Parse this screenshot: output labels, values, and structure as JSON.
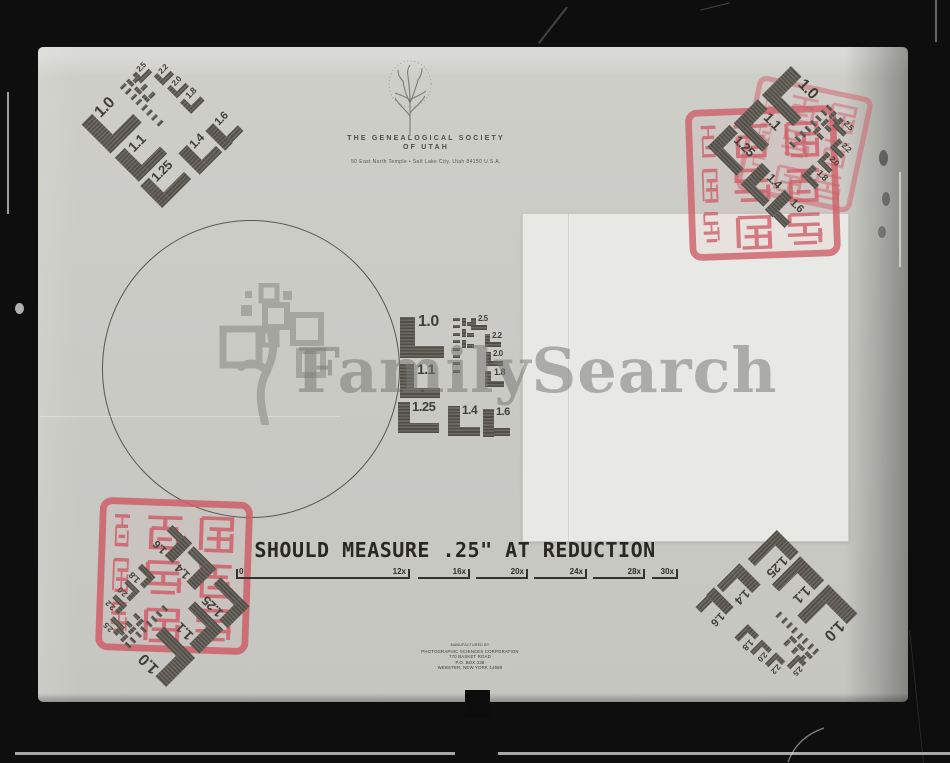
{
  "header": {
    "org_line1": "THE GENEALOGICAL SOCIETY",
    "org_line2": "OF UTAH",
    "address": "50 East North Temple • Salt Lake City, Utah 84150 U.S.A."
  },
  "watermark": {
    "text": "FamilySearch"
  },
  "caption": {
    "text": "SHOULD MEASURE .25\" AT REDUCTION"
  },
  "ruler": {
    "zero_label": "0",
    "baseline_y": 577,
    "segments": [
      {
        "label": "12x",
        "x1": 238,
        "x2": 410
      },
      {
        "label": "16x",
        "x1": 418,
        "x2": 470
      },
      {
        "label": "20x",
        "x1": 476,
        "x2": 528
      },
      {
        "label": "24x",
        "x1": 534,
        "x2": 587
      },
      {
        "label": "28x",
        "x1": 593,
        "x2": 645
      },
      {
        "label": "30x",
        "x1": 652,
        "x2": 678
      }
    ]
  },
  "resolution_chart": {
    "large_labels": [
      "1.0",
      "1.1",
      "1.25",
      "1.4",
      "1.6"
    ],
    "small_labels": [
      "2.5",
      "2.2",
      "2.0",
      "1.8"
    ],
    "placements": [
      {
        "name": "top-left",
        "rotation": -45
      },
      {
        "name": "top-right",
        "rotation": 45
      },
      {
        "name": "center",
        "rotation": 0
      },
      {
        "name": "bottom-right",
        "rotation": 135
      },
      {
        "name": "bottom-left",
        "rotation": -135
      }
    ]
  },
  "manufacturer": {
    "lines": [
      "MANUFACTURED BY",
      "PHOTOGRAPHIC SCIENCES CORPORATION",
      "770 BASKET ROAD",
      "P.O. BOX 338",
      "WEBSTER, NEW YORK  14580"
    ]
  },
  "stamps": {
    "kind": "chinese-seal-stamp",
    "color": "#cf5f69",
    "count": 3
  },
  "colors": {
    "film_black": "#0e0e0e",
    "card_gray": "#c9c9c4",
    "pattern_dark": "#55534c",
    "page_white": "#e8e8e4",
    "seal_red": "#cf5f69",
    "watermark_gray": "#787874"
  }
}
